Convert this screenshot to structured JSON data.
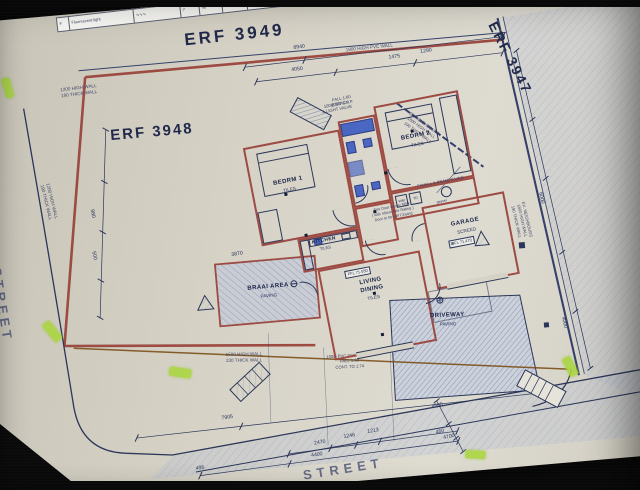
{
  "sheet": {
    "colors": {
      "paper": "#d6d2c6",
      "ink": "#2a3558",
      "wall_red": "#9c4a42",
      "fixture_blue": "#3a5ac2",
      "highlight_green": "#a9d63c",
      "sewer_brown": "#7a4e17"
    },
    "schedule": {
      "cells": [
        "F",
        "Fluorescent light",
        "∿∿∿",
        "7",
        "40",
        "3.2",
        "300"
      ]
    },
    "erf_labels": {
      "top": "ERF 3949",
      "main": "ERF 3948",
      "right": "ERF 3947"
    },
    "streets": {
      "left": "ER STREET",
      "bottom": "STREET"
    },
    "rooms": {
      "bedrm1": {
        "name": "BEDRM 1",
        "finish": "TILES"
      },
      "bedrm2": {
        "name": "BEDRM 2",
        "finish": "TILES"
      },
      "kitchen": {
        "name": "KITCHEN",
        "finish": "TILES"
      },
      "living": {
        "line1": "LIVING",
        "line2": "DINING",
        "finish": "TILES",
        "ffl": "FFL 71.550"
      },
      "garage": {
        "name": "GARAGE",
        "finish": "SCREED",
        "ffl": "FFL 71.470"
      },
      "braai": {
        "name": "BRAAI AREA",
        "finish": "PAVING"
      },
      "driveway": {
        "name": "DRIVEWAY",
        "finish": "PAVING"
      },
      "laundry": {
        "wm": "WM",
        "td": "TD",
        "geyser": "geyser"
      }
    },
    "walls": {
      "w1200": "1200 HIGH WALL",
      "w1200b": "190 THICK WALL",
      "w1500": "1500 HIGH WALL",
      "w1500b": "230 THICK WALL",
      "pvc": "1800 HIGH PVC WALL",
      "neighbours_1": "EX. NEIGHBOURS",
      "neighbours_2": "1800 HIGH WALL",
      "neighbours_3": "190 THICK WALL"
    },
    "notes": {
      "fire_1": "Fire Door as per NBR",
      "fire_2": "( with 40min Fire Rating )",
      "fire_3": "Door to be self Closing",
      "fwall": "F/WALL & BEAMFILLING",
      "stack_1": "100Ø STACK",
      "stack_2": "& LIGHT VALVE",
      "sewer_1": "100Ø PVC SEWERLINE",
      "sewer_2": "FALL 1:60",
      "sewer_3": "CONT. TO 1:74",
      "fall": "FALL 1:60",
      "svp": "100Ø S.V.P."
    },
    "dims": {
      "d7905": "7905",
      "d2470": "2470",
      "d1246": "1246",
      "d1213": "1213",
      "d4400": "4400",
      "d495": "495",
      "d4500": "4500",
      "d450": "450",
      "d4700": "4700",
      "d4050": "4050",
      "d1475": "1475",
      "d1290": "1290",
      "d8940": "8940",
      "d3870": "3870",
      "d6000": "6000",
      "d4000": "4000",
      "d980": "980",
      "d500": "500"
    }
  }
}
